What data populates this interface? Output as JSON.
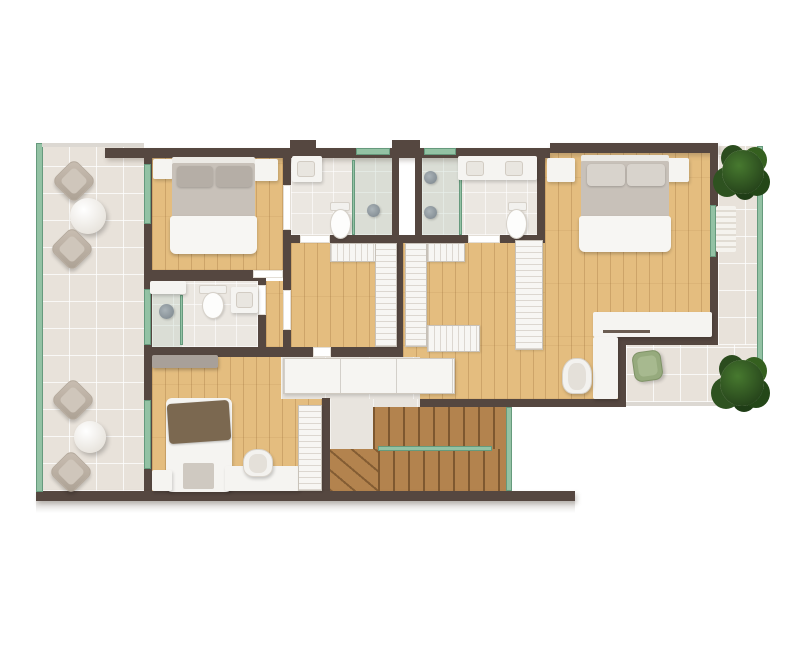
{
  "scene": {
    "kind": "architectural floor plan",
    "view": "top-down 3D render",
    "level": "upper floor of a residence",
    "background": "#ffffff",
    "visible_text": ""
  },
  "palette": {
    "bg": "#ffffff",
    "wall": "#554740",
    "wood": "#e4bd7f",
    "stair": "#b3834e",
    "tile": "#e8e2da",
    "bath": "#ebe7e1",
    "glass": "#93c2a4",
    "glassdark": "#669a7d",
    "furn": "#f5f4f1",
    "hatch": "#dcd7d0",
    "pillow": "#b5aea6",
    "bedgray": "#c8c1b9",
    "duvet": "#f7f6f3",
    "brown": "#7b6850",
    "dresser": "#a8a099",
    "chairgreen": "#96aa7d",
    "plant": "#2b4c1e"
  },
  "rooms": [
    {
      "id": "terrace",
      "floor": "tile",
      "items": [
        "sun-lounger",
        "round-side-table",
        "sun-lounger",
        "sun-lounger",
        "round-side-table",
        "sun-lounger"
      ]
    },
    {
      "id": "bedroom-1",
      "floor": "wood",
      "items": [
        "double-bed",
        "nightstand",
        "nightstand"
      ]
    },
    {
      "id": "bathroom-1",
      "floor": "stone-tile",
      "items": [
        "vanity-sink",
        "toilet",
        "walk-in-shower"
      ]
    },
    {
      "id": "light-well",
      "floor": "none",
      "items": []
    },
    {
      "id": "bathroom-2",
      "floor": "stone-tile",
      "items": [
        "walk-in-shower",
        "double-vanity",
        "toilet"
      ]
    },
    {
      "id": "master-bedroom",
      "floor": "wood",
      "items": [
        "double-bed",
        "nightstand",
        "nightstand",
        "corner-desk",
        "desk-chair"
      ]
    },
    {
      "id": "walk-in-closet-left",
      "floor": "wood",
      "items": [
        "wardrobe",
        "wardrobe"
      ]
    },
    {
      "id": "walk-in-closet-right",
      "floor": "wood",
      "items": [
        "wardrobe",
        "wardrobe",
        "wardrobe",
        "wardrobe"
      ]
    },
    {
      "id": "hallway",
      "floor": "stone-tile",
      "items": [
        "sideboard"
      ]
    },
    {
      "id": "bathroom-3",
      "floor": "stone-tile",
      "items": [
        "cabinet",
        "toilet",
        "vanity-sink",
        "walk-in-shower"
      ]
    },
    {
      "id": "bedroom-2",
      "floor": "wood",
      "items": [
        "dresser",
        "single-bed",
        "desk",
        "desk-chair",
        "wardrobe",
        "cabinet"
      ]
    },
    {
      "id": "staircase",
      "floor": "stair-wood",
      "items": [
        "upper-flight",
        "lower-flight",
        "winder-steps",
        "glass-balustrade"
      ]
    },
    {
      "id": "balcony-right",
      "floor": "tile",
      "items": [
        "plant",
        "curtain",
        "green-lounge-chair",
        "plant"
      ]
    }
  ],
  "glazing": [
    "terrace-glass-wall",
    "bedroom-1-window",
    "bathroom-3-window",
    "bedroom-2-window",
    "shower-screens",
    "bathroom-top-windows",
    "master-window",
    "balcony-glass-wall",
    "stair-glass-balustrade"
  ]
}
